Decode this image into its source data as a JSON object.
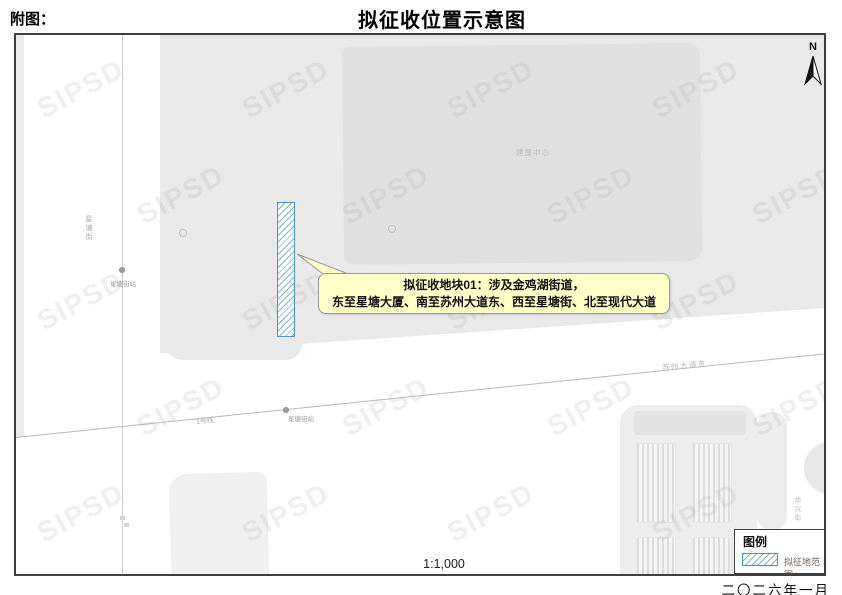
{
  "page": {
    "label_fig": "附图：",
    "title": "拟征收位置示意图",
    "scale": "1:1,000",
    "date": "二〇二六年一月",
    "watermark": "SIPSD",
    "north_label": "N"
  },
  "callout": {
    "line1": "拟征收地块01：涉及金鸡湖街道，",
    "line2": "东至星塘大厦、南至苏州大道东、西至星塘街、北至现代大道"
  },
  "legend": {
    "title": "图例",
    "items": [
      {
        "label": "拟征地范围",
        "swatch": "blue-diagonal-hatch"
      }
    ]
  },
  "map_labels": {
    "road_vertical": "星塘街",
    "station1": "星塘街站",
    "station2": "星塘街站",
    "metro_line": "1号线",
    "road_horizontal": "苏州大道东",
    "building_top": "建屋中心",
    "road_east_vertical": "华兴街"
  },
  "colors": {
    "site_border_blue": "#4d90d1",
    "site_hatch_blue": "#7fb0de",
    "callout_fill": "#ffffc8",
    "building_gray": "#e9e9e9"
  }
}
